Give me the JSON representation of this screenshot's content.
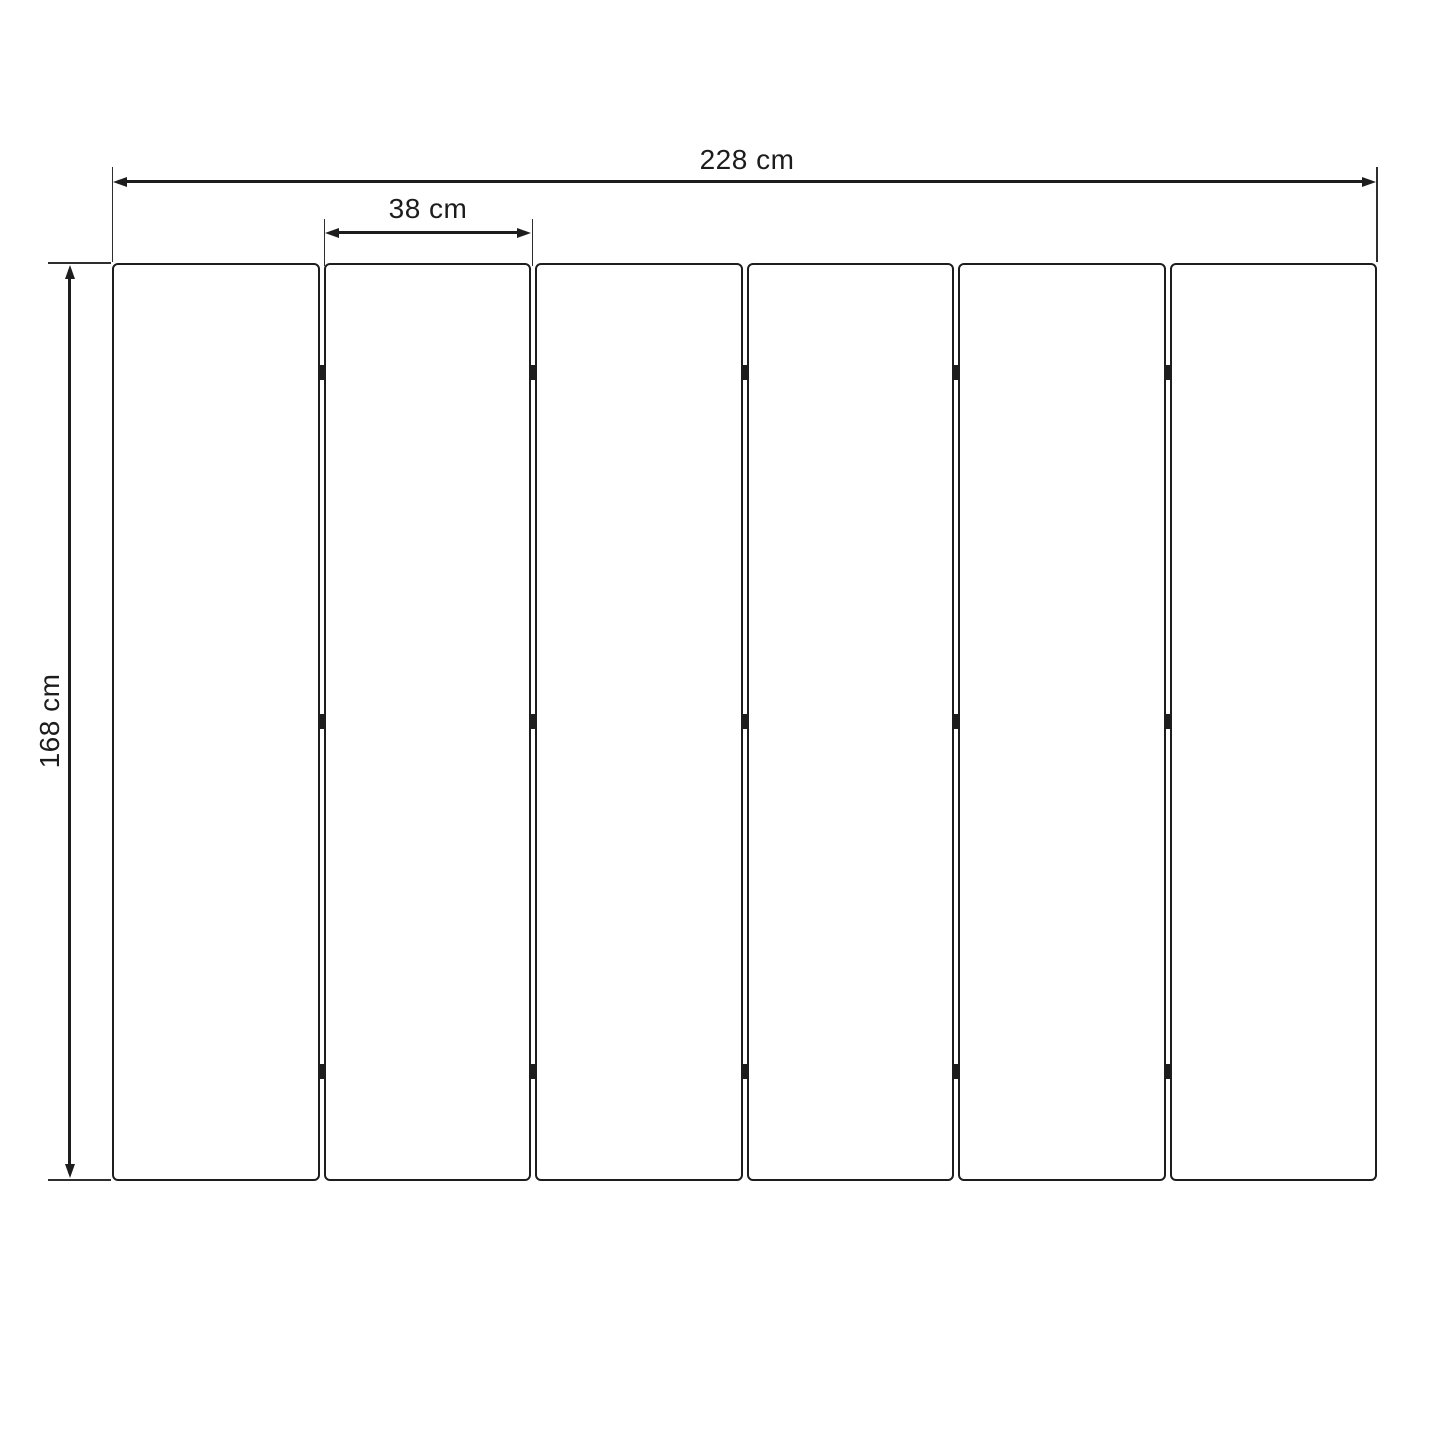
{
  "colors": {
    "background": "#ffffff",
    "line": "#1d1d1d",
    "text": "#1c1c1c"
  },
  "dimensions": {
    "total_width": {
      "label": "228 cm"
    },
    "panel_width": {
      "label": "38 cm"
    },
    "height": {
      "label": "168 cm"
    }
  },
  "panels": {
    "count": 6,
    "joint_count": 5,
    "hinge_marks_per_joint": 3
  }
}
